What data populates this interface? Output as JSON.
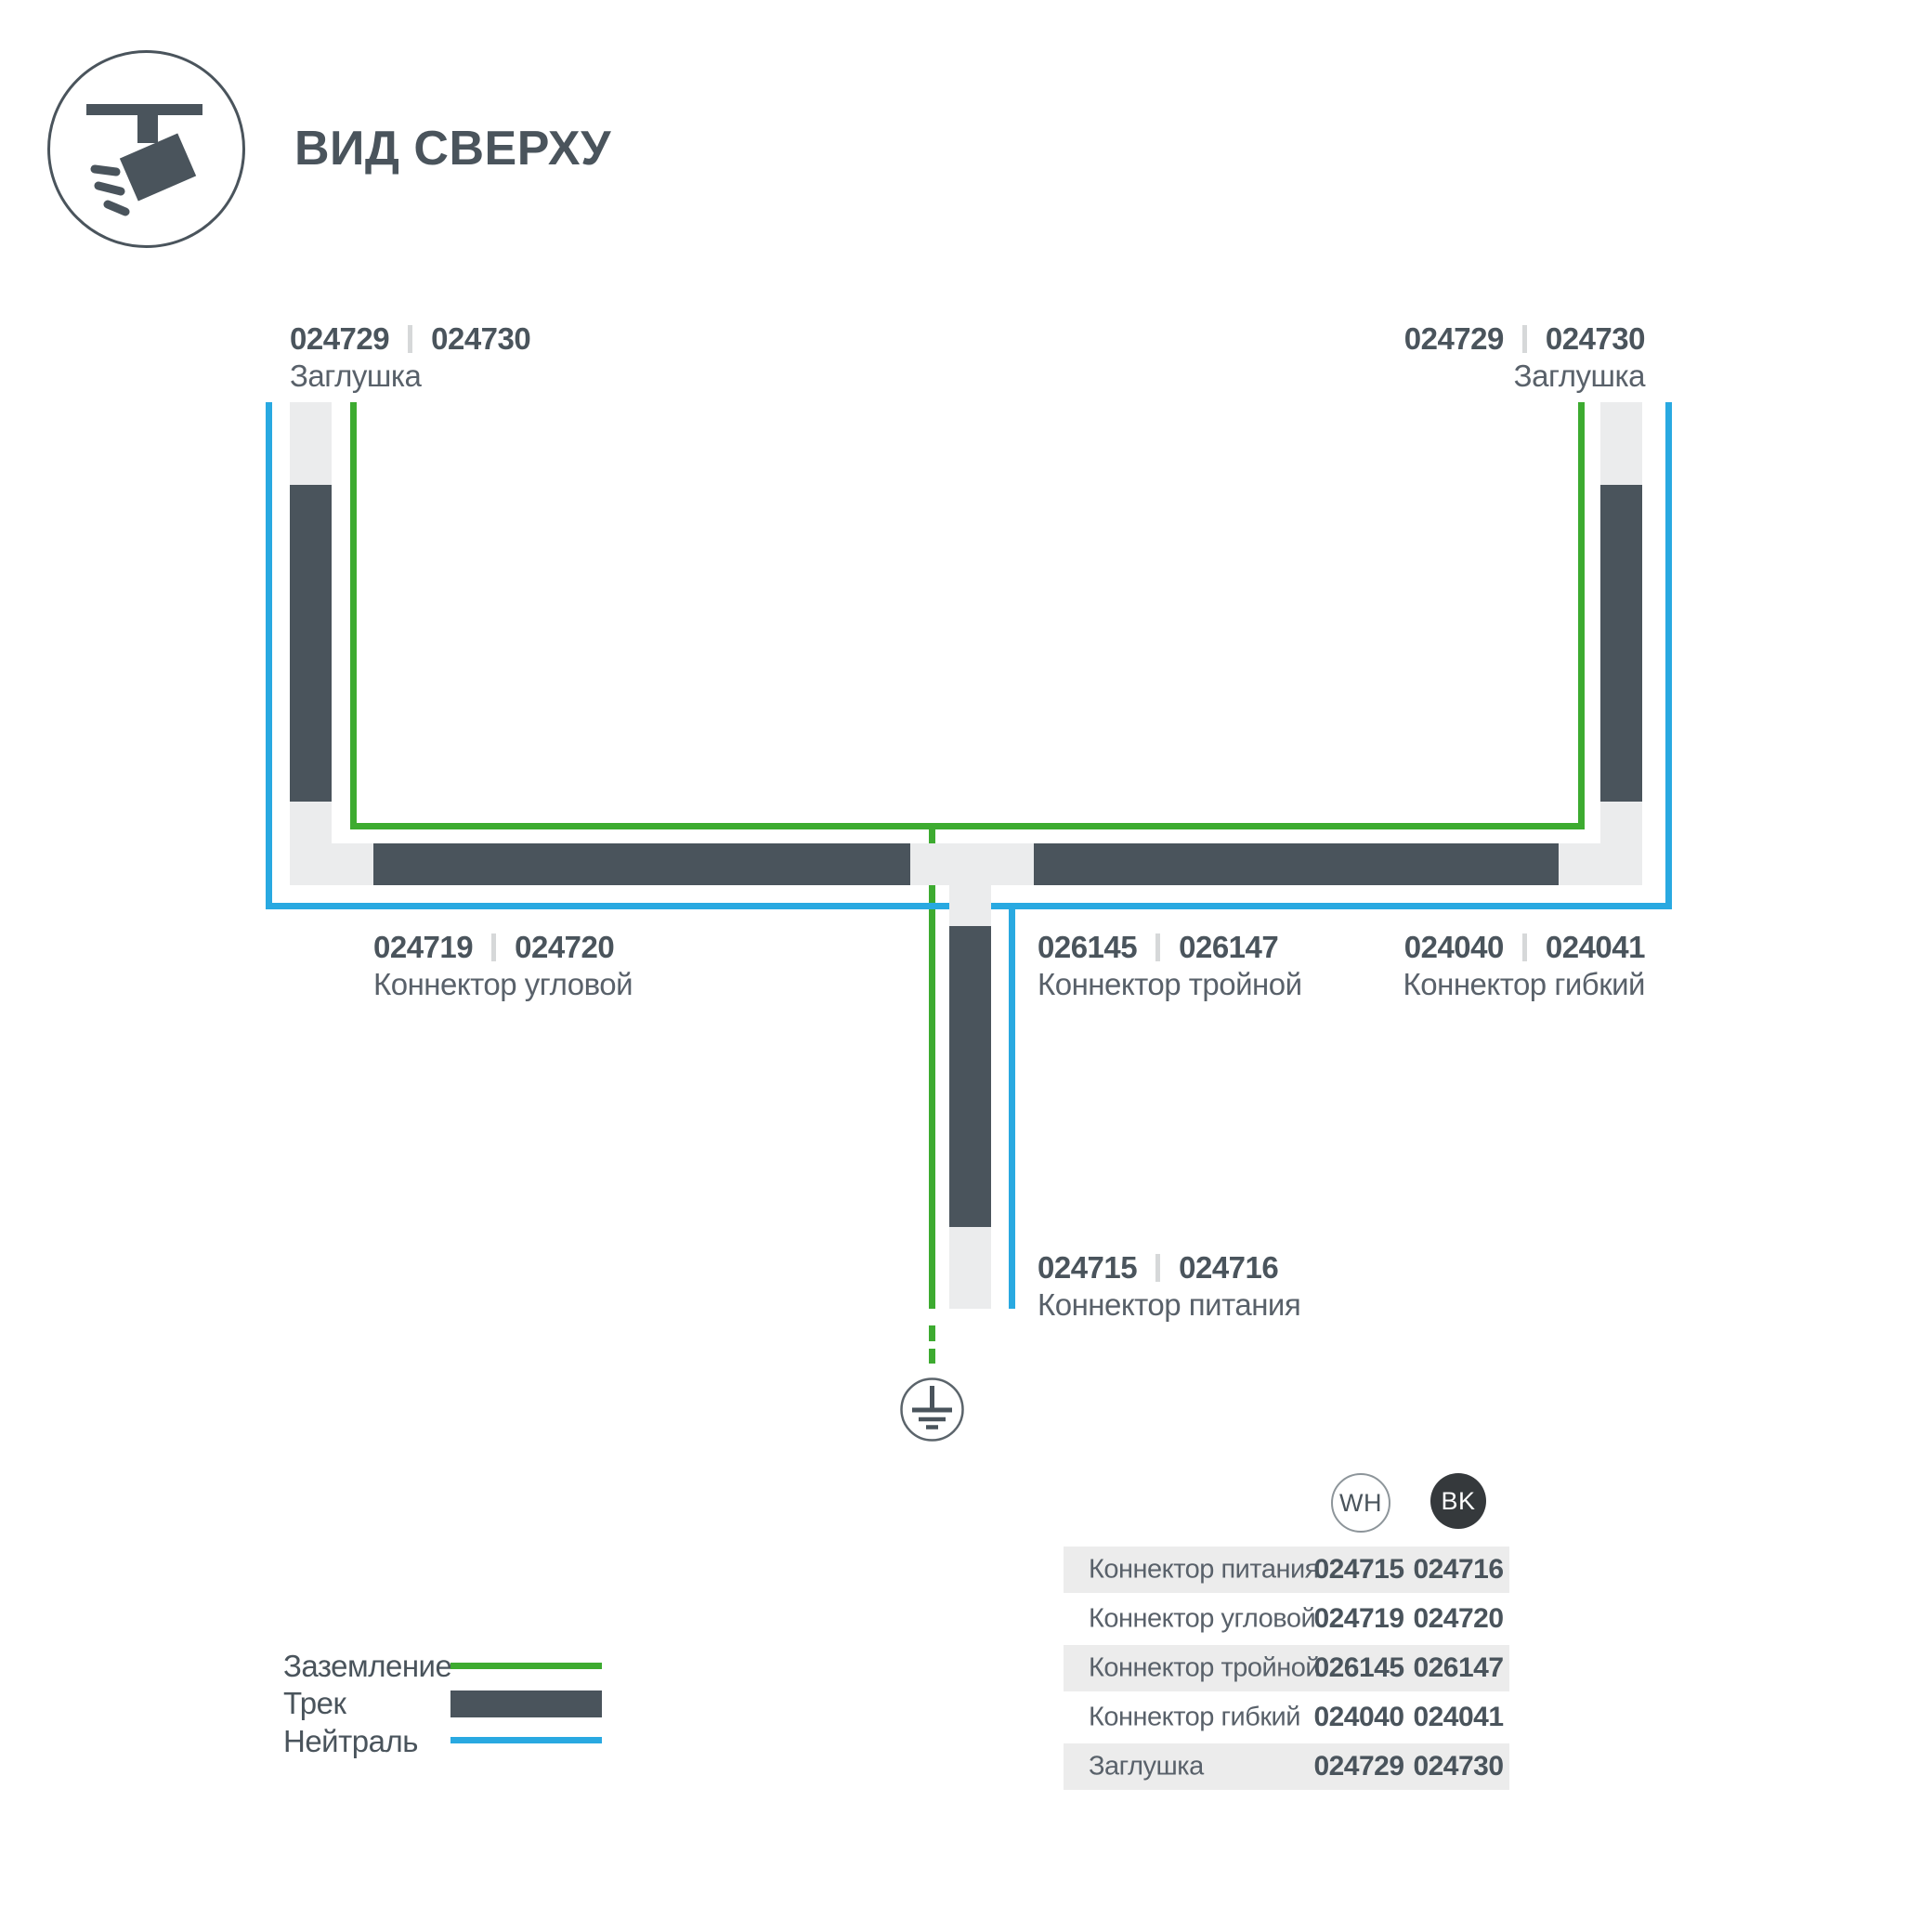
{
  "title": "ВИД СВЕРХУ",
  "colors": {
    "track": "#4a545c",
    "connector_light": "#ebeced",
    "ground_green": "#3dab30",
    "neutral_blue": "#29a9e1",
    "table_row_bg": "#ececec",
    "bk_badge": "#35393c"
  },
  "labels": {
    "cap_top_left": {
      "code_wh": "024729",
      "code_bk": "024730",
      "name": "Заглушка"
    },
    "cap_top_right": {
      "code_wh": "024729",
      "code_bk": "024730",
      "name": "Заглушка"
    },
    "corner": {
      "code_wh": "024719",
      "code_bk": "024720",
      "name": "Коннектор угловой"
    },
    "triple": {
      "code_wh": "026145",
      "code_bk": "026147",
      "name": "Коннектор тройной"
    },
    "flex": {
      "code_wh": "024040",
      "code_bk": "024041",
      "name": "Коннектор гибкий"
    },
    "power": {
      "code_wh": "024715",
      "code_bk": "024716",
      "name": "Коннектор питания"
    }
  },
  "legend": {
    "items": [
      {
        "label": "Заземление",
        "swatch": "ground-line"
      },
      {
        "label": "Трек",
        "swatch": "track-bar"
      },
      {
        "label": "Нейтраль",
        "swatch": "neutral-line"
      }
    ]
  },
  "table": {
    "columns": [
      {
        "label": "WH"
      },
      {
        "label": "BK"
      }
    ],
    "rows": [
      {
        "name": "Коннектор питания",
        "wh": "024715",
        "bk": "024716"
      },
      {
        "name": "Коннектор угловой",
        "wh": "024719",
        "bk": "024720"
      },
      {
        "name": "Коннектор тройной",
        "wh": "026145",
        "bk": "026147"
      },
      {
        "name": "Коннектор гибкий",
        "wh": "024040",
        "bk": "024041"
      },
      {
        "name": "Заглушка",
        "wh": "024729",
        "bk": "024730"
      }
    ]
  }
}
